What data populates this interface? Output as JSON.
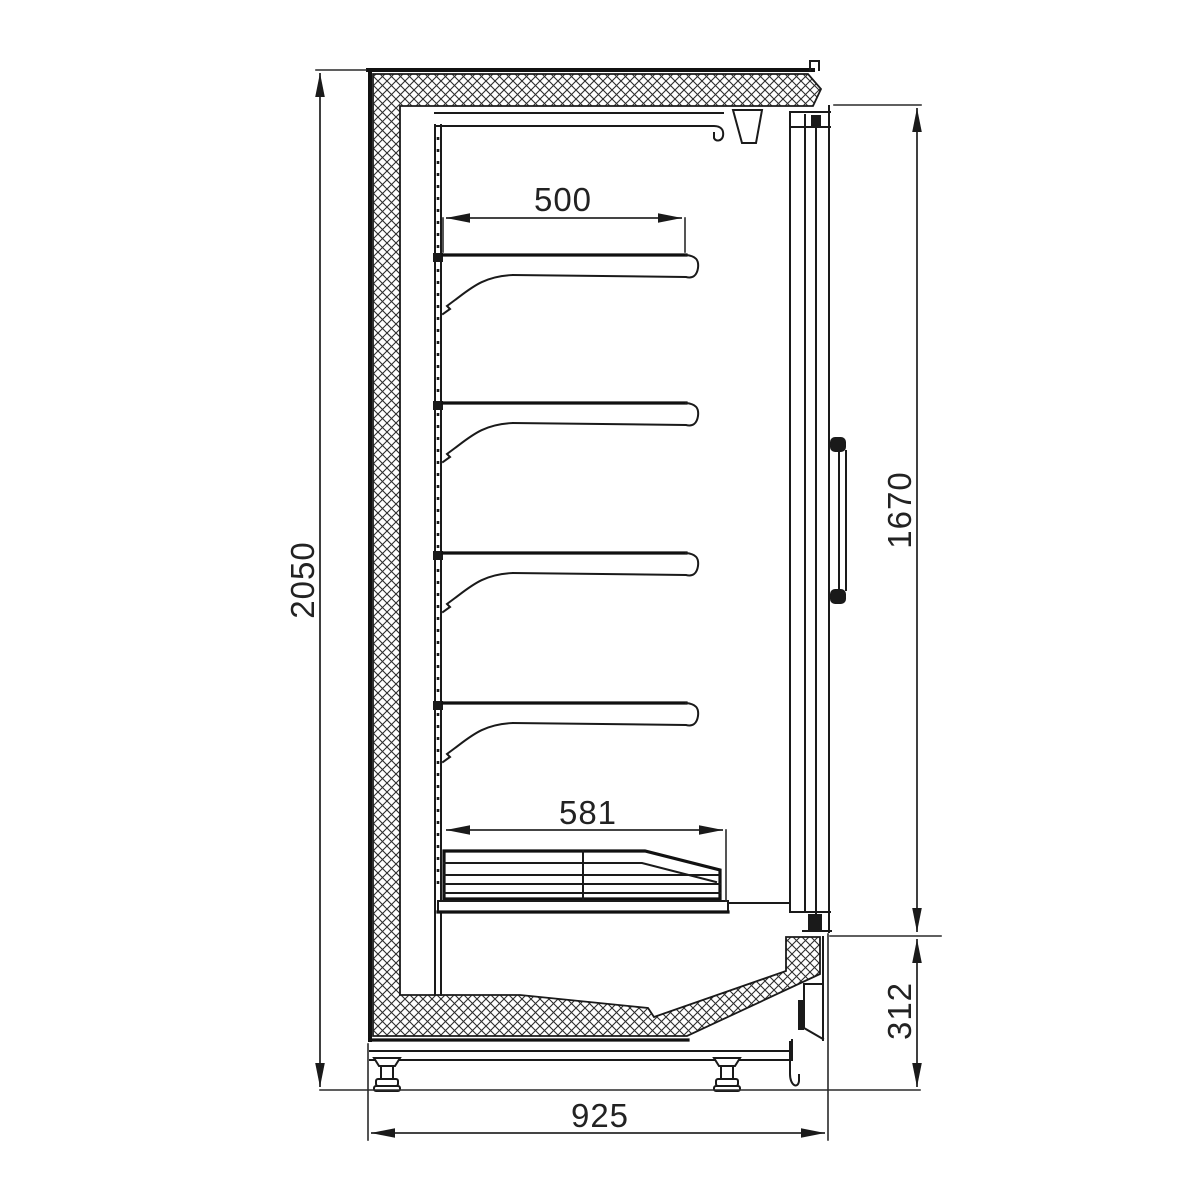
{
  "meta": {
    "title": "Refrigerated display cabinet side cross-section drawing",
    "background_color": "#ffffff",
    "line_color": "#1a1a1a",
    "hatch_style": "diagonal cross-hatch insulation"
  },
  "dimensions": {
    "overall_height": {
      "value": "2050",
      "orientation": "vertical",
      "location": "left side, full cabinet height"
    },
    "door_height": {
      "value": "1670",
      "orientation": "vertical",
      "location": "right side, glass door section"
    },
    "base_height": {
      "value": "312",
      "orientation": "vertical",
      "location": "right side, base section"
    },
    "overall_depth": {
      "value": "925",
      "orientation": "horizontal",
      "location": "bottom, full cabinet depth"
    },
    "shelf_depth": {
      "value": "500",
      "orientation": "horizontal",
      "location": "top shelf depth"
    },
    "bottom_shelf_depth": {
      "value": "581",
      "orientation": "horizontal",
      "location": "bottom deck depth"
    }
  },
  "components": {
    "shelf_count": 4,
    "shelves": "cantilever shelves with support brackets on perforated back panel",
    "bottom_deck": "layered bottom deck with chamfered front and centre divider",
    "door": "glass door in section with vertical grab handle",
    "insulation": "cross-hatched insulated body: back wall, top and sloped base",
    "feet_count": 2,
    "feet": "adjustable levelling feet on base frame"
  }
}
